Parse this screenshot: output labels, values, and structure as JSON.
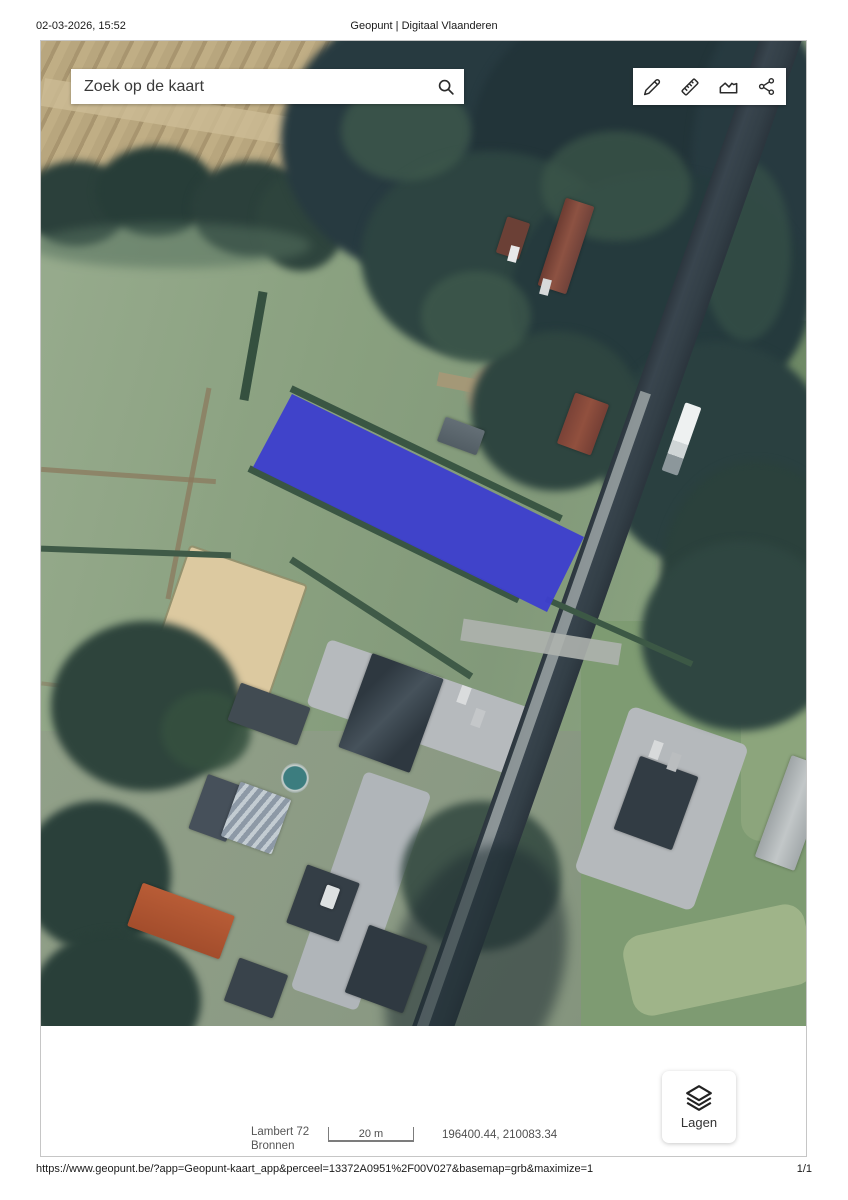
{
  "print_header": {
    "datetime": "02-03-2026, 15:52",
    "title": "Geopunt | Digitaal Vlaanderen"
  },
  "map": {
    "search": {
      "placeholder": "Zoek op de kaart",
      "icon": "search-icon"
    },
    "toolbar": {
      "tools": [
        {
          "name": "draw",
          "icon": "pencil-icon"
        },
        {
          "name": "measure",
          "icon": "ruler-icon"
        },
        {
          "name": "elevation-profile",
          "icon": "terrain-profile-icon"
        },
        {
          "name": "share",
          "icon": "share-icon"
        }
      ]
    },
    "basemap": "aerial-orthophoto",
    "parcel_highlight": {
      "color": "#3d3fcd"
    }
  },
  "map_footer": {
    "projection": "Lambert 72",
    "sources_label": "Bronnen",
    "scale_label": "20 m",
    "coordinates": "196400.44, 210083.34",
    "layers_label": "Lagen",
    "layers_icon": "layers-icon"
  },
  "print_footer": {
    "url": "https://www.geopunt.be/?app=Geopunt-kaart_app&perceel=13372A0951%2F00V027&basemap=grb&maximize=1",
    "page": "1/1"
  }
}
